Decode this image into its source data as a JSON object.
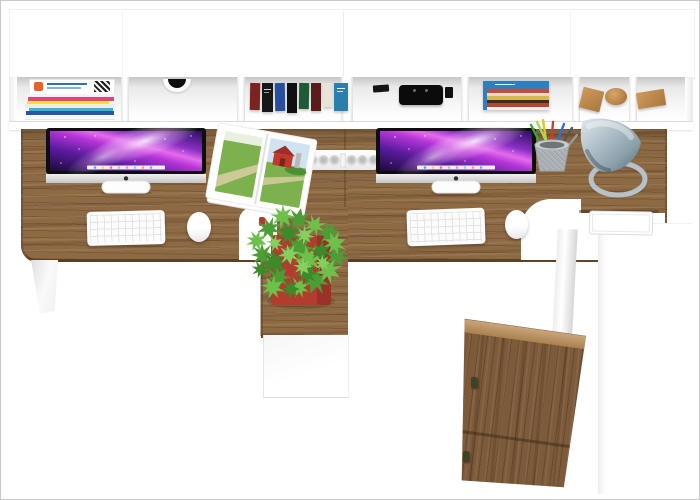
{
  "scene": {
    "type": "3d-product-render-top-view",
    "description": "Top-down catalog render of a white two-person workstation with oak desktops, wall hutch cubbies, two iMac computers, keyboards, mice, lamp, plant and storage cabinet",
    "background_color": "#ffffff",
    "frame_color": "#c8c8c8"
  },
  "palette": {
    "white": "#ffffff",
    "wood": "#8e6a44",
    "wood_rim": "rgba(72,46,22,0.55)",
    "wood_cabinet": "#7c5a3a",
    "wood_cabinet_top": "#b98c55",
    "wood_block": "#c08a4e",
    "pot_red": "#b23c2e",
    "pot_red_dark": "#8e2d24",
    "plant_greens": [
      "#4e9c35",
      "#6fbf4b",
      "#3c8a28",
      "#85cf5f"
    ],
    "lamp_steel": "#8aa0ab",
    "lamp_ring": "#b6c2c8",
    "screen_deep": "#1a0b38",
    "screen_violet": "#5a1b9e",
    "screen_magenta": "#b636d8",
    "screen_pink": "#e56bee",
    "barn_red": "#c0392b",
    "barn_roof": "#a32d26",
    "field_green": "#7cb14d",
    "sky_blue": "#cfe3f0",
    "path_tan": "#d6cd9e",
    "hedge_green": "#4e8f33",
    "silo_gray": "#b9b9b9",
    "camera_black": "#0b0b0b",
    "knob_olive": "#3f4326"
  },
  "hutch": {
    "compartment_count": 7,
    "magazines": {
      "cover_accent": "#e8622d",
      "cover_line1": "#2e6fb8",
      "cover_line2": "#7fb3e0",
      "spine_colors": [
        "#f4f4f4",
        "#e1447e",
        "#f0e13c",
        "#ececec",
        "#3bb3c9",
        "#2855a8",
        "#f7f7f7"
      ]
    },
    "grommet_hole": "#0c0c0c",
    "books_row_colors": [
      "#7b2320",
      "#17171a",
      "#2a4e9e",
      "#101013",
      "#1e5a36",
      "#5a1d1c",
      "#e9e4d6",
      "#2a7fae"
    ],
    "book_stack": {
      "edge": "#2e7fc0",
      "stripe_colors": [
        "#2e7fc0",
        "#c84a3a",
        "#e8d9c6",
        "#d8b84a",
        "#34312c",
        "#b8442f",
        "#f0efec"
      ]
    }
  },
  "imac": {
    "count": 2,
    "dock_colors": [
      "#4da3ff",
      "#ffd24d",
      "#ff6b5e",
      "#9bdc6a",
      "#c39bff",
      "#7fd8d4",
      "#ff9f4a",
      "#6aa9ff"
    ]
  },
  "pencils": {
    "colors": [
      "#3aa63a",
      "#e8c22a",
      "#d23b2f",
      "#2f6fd2",
      "#555555",
      "#9adf4f",
      "#999999"
    ]
  }
}
